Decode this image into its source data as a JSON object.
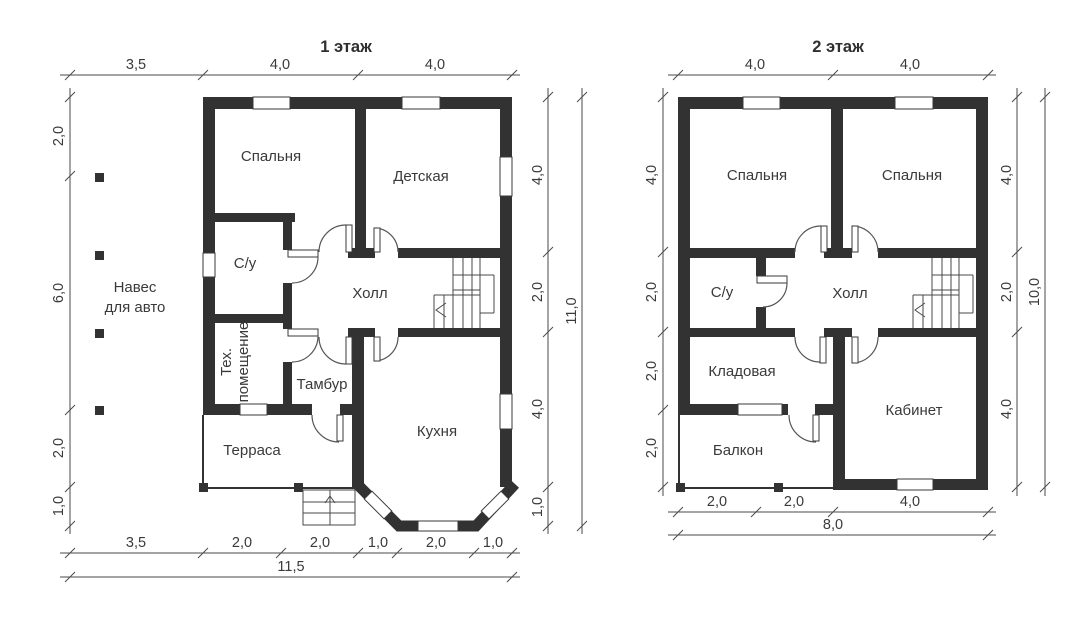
{
  "titles": {
    "plan1": "1 этаж",
    "plan2": "2 этаж"
  },
  "plan1": {
    "rooms": {
      "bedroom": "Спальня",
      "nursery": "Детская",
      "bathroom": "С/у",
      "hall": "Холл",
      "tech_line1": "Тех.",
      "tech_line2": "помещение",
      "tambour": "Тамбур",
      "terrace": "Терраса",
      "kitchen": "Кухня",
      "carport_line1": "Навес",
      "carport_line2": "для авто"
    },
    "dims": {
      "top": [
        "3,5",
        "4,0",
        "4,0"
      ],
      "left": [
        "2,0",
        "6,0",
        "2,0",
        "1,0"
      ],
      "right": [
        "4,0",
        "2,0",
        "4,0",
        "1,0"
      ],
      "right_total": "11,0",
      "bottom": [
        "3,5",
        "2,0",
        "2,0",
        "1,0",
        "2,0",
        "1,0"
      ],
      "bottom_total": "11,5"
    }
  },
  "plan2": {
    "rooms": {
      "bedroom_left": "Спальня",
      "bedroom_right": "Спальня",
      "bathroom": "С/у",
      "hall": "Холл",
      "storage": "Кладовая",
      "balcony": "Балкон",
      "study": "Кабинет"
    },
    "dims": {
      "top": [
        "4,0",
        "4,0"
      ],
      "left": [
        "4,0",
        "2,0",
        "2,0",
        "2,0"
      ],
      "right": [
        "4,0",
        "2,0",
        "4,0"
      ],
      "right_total": "10,0",
      "bottom": [
        "2,0",
        "2,0",
        "4,0"
      ],
      "bottom_total": "8,0"
    }
  },
  "colors": {
    "wall": "#323232",
    "line": "#4a4a4a",
    "text": "#3a3a3a",
    "background": "#ffffff"
  }
}
